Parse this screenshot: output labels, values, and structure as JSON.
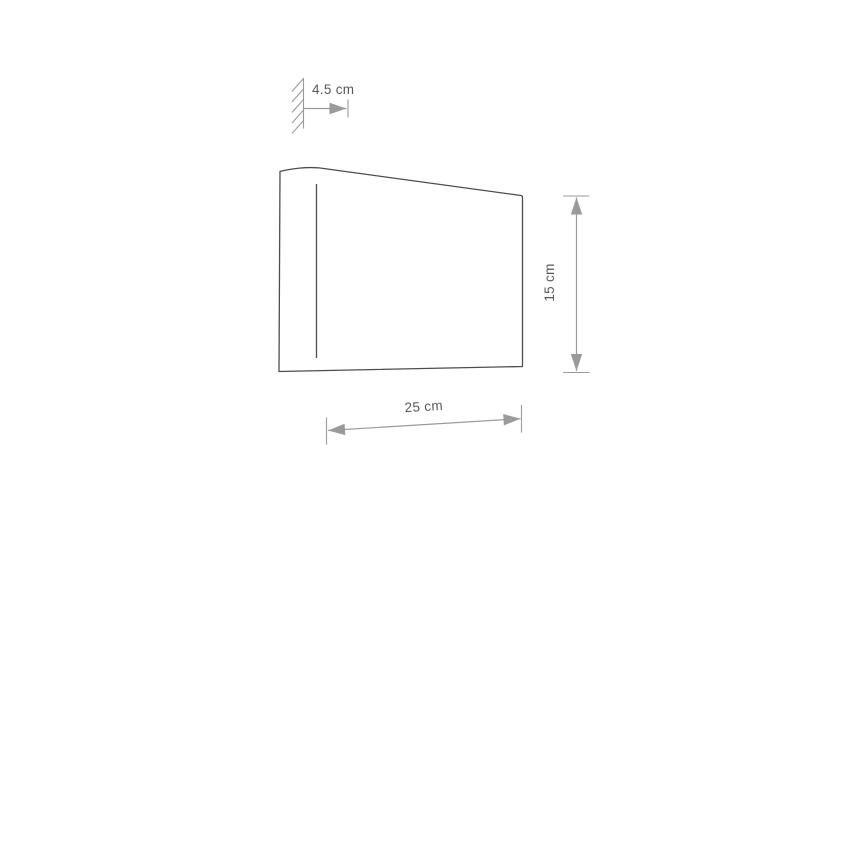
{
  "colors": {
    "background": "#ffffff",
    "outline": "#4d4d4f",
    "dimension": "#9a9a9c",
    "text": "#58585b"
  },
  "diagram": {
    "dimensions": {
      "depth": {
        "label": "4.5 cm"
      },
      "height": {
        "label": "15 cm"
      },
      "width": {
        "label": "25 cm"
      }
    }
  }
}
